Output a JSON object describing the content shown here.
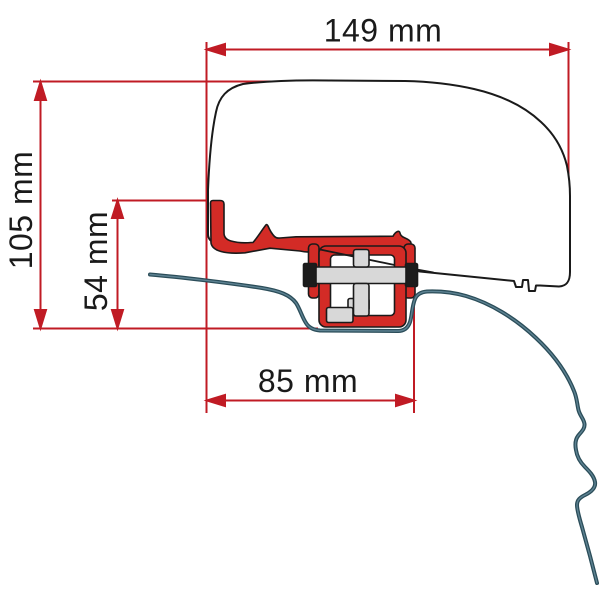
{
  "diagram": {
    "type": "technical-dimension-drawing",
    "dimensions": {
      "total_width": {
        "label": "149 mm"
      },
      "total_height": {
        "label": "105 mm"
      },
      "bracket_height": {
        "label": "54 mm"
      },
      "bracket_width": {
        "label": "85 mm"
      }
    },
    "colors": {
      "dimension_red": "#c01b24",
      "bracket_red": "#d32b26",
      "roof_profile_teal": "#2b4d59",
      "roof_profile_core": "#5d8292",
      "outline_black": "#1a1a1a",
      "hardware_gray": "#d8d8d8",
      "background": "#ffffff"
    }
  }
}
